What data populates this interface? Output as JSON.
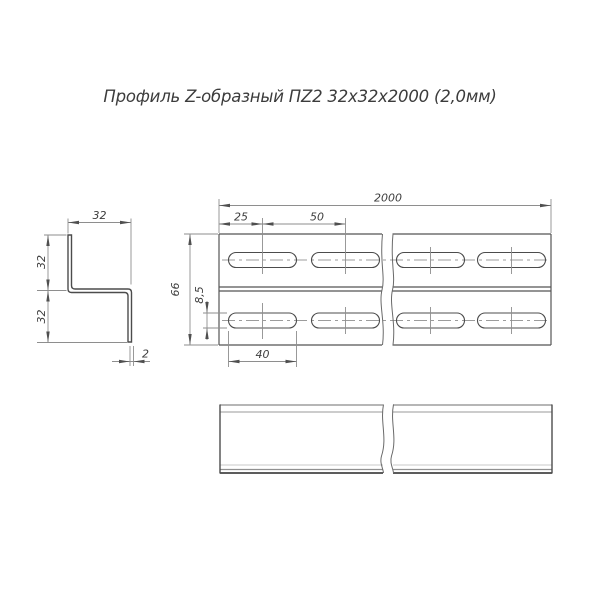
{
  "title": "Профиль Z-образный ПZ2 32х32х2000 (2,0мм)",
  "drawing": {
    "type": "technical-drawing",
    "views": [
      "cross-section",
      "plan-view",
      "side-view"
    ],
    "dimensions": {
      "flange_width": "32",
      "upper_leg": "32",
      "lower_leg": "32",
      "thickness": "2",
      "length": "2000",
      "slot_edge_offset": "25",
      "slot_pitch": "50",
      "flat_width": "66",
      "slot_width": "8,5",
      "slot_length": "40"
    },
    "colors": {
      "contour": "#4c4c4c",
      "thin_line": "#8e8e8e",
      "centerline": "#9c9c9c",
      "text": "#3d3d3d",
      "background": "#ffffff"
    }
  }
}
